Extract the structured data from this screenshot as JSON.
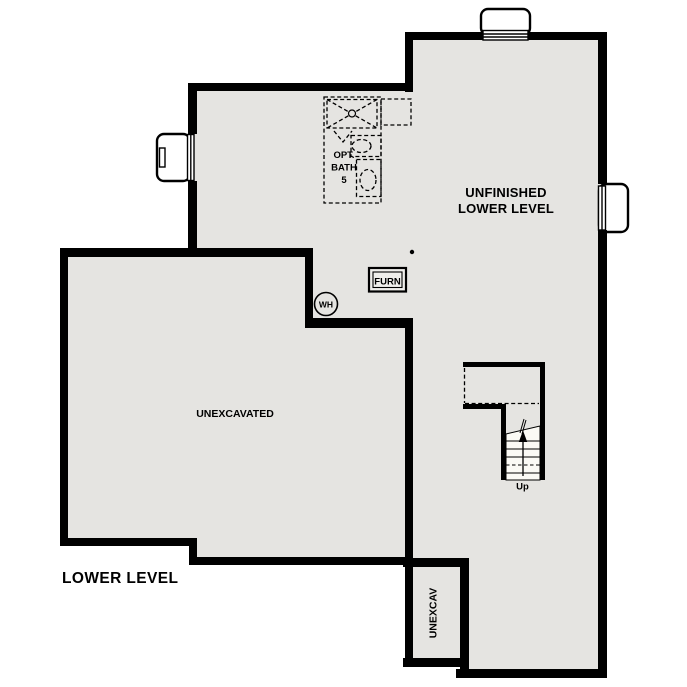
{
  "colors": {
    "background": "#ffffff",
    "floor": "#e5e4e1",
    "wall": "#000000",
    "stair": "#fbfaf5",
    "furn_fill": "#f0efec"
  },
  "labels": {
    "plan_title": "LOWER LEVEL",
    "unfinished_line1": "UNFINISHED",
    "unfinished_line2": "LOWER LEVEL",
    "unexcavated": "UNEXCAVATED",
    "unexcav": "UNEXCAV",
    "bath_line1": "OPT.",
    "bath_line2": "BATH",
    "bath_line3": "5",
    "furnace": "FURN",
    "water_heater": "WH",
    "stairs_up": "Up"
  }
}
